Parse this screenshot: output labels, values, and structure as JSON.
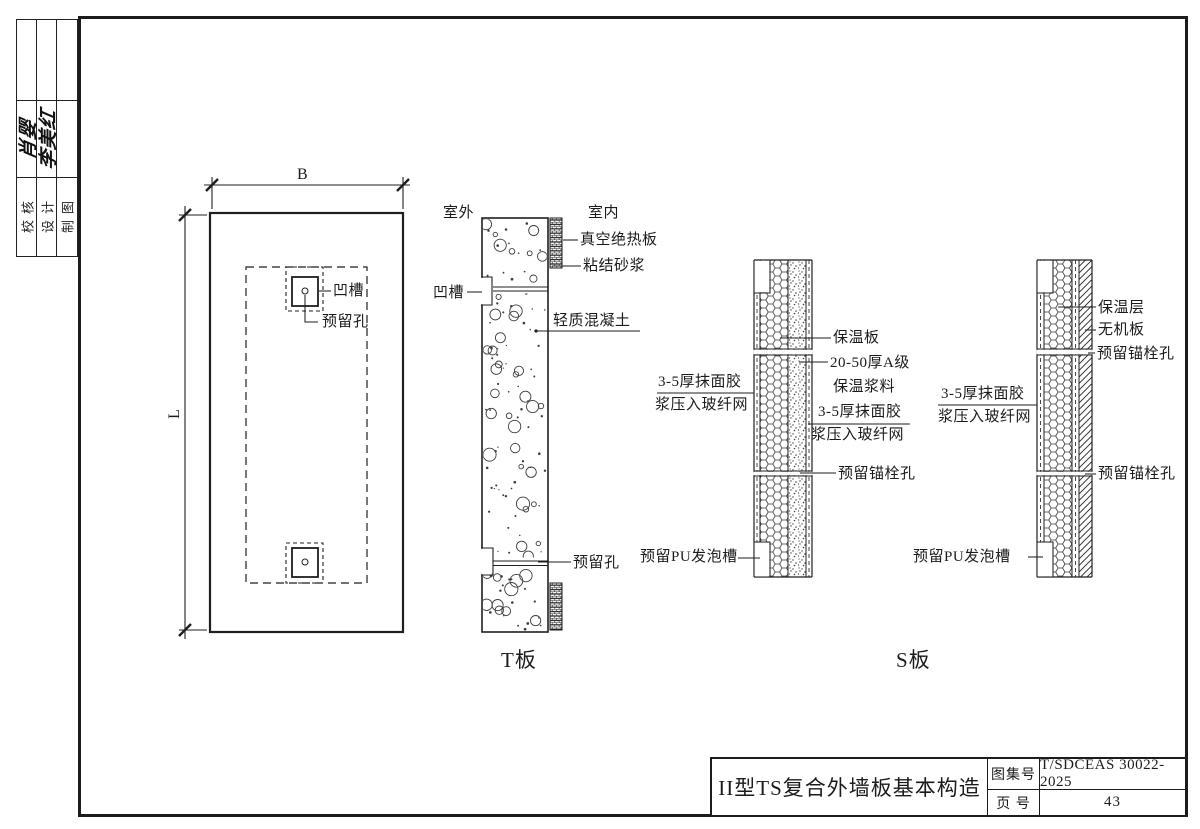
{
  "sidebar": {
    "col1_label": "校核",
    "col2_label": "设计",
    "col3_label": "制图",
    "col1_signature": "肖婴",
    "col2_signature": "李美红"
  },
  "plan": {
    "dim_width": "B",
    "dim_length": "L",
    "groove": "凹槽",
    "reserved_hole": "预留孔"
  },
  "t_panel": {
    "caption": "T板",
    "outdoor": "室外",
    "indoor": "室内",
    "vacuum_insulation_panel": "真空绝热板",
    "bonding_mortar": "粘结砂浆",
    "groove": "凹槽",
    "lightweight_concrete": "轻质混凝土",
    "reserved_hole": "预留孔"
  },
  "s_panel": {
    "caption": "S板",
    "left_section": {
      "insulation_board": "保温板",
      "slurry_line1": "20-50厚A级",
      "slurry_line2": "保温浆料",
      "outer_render_line1": "3-5厚抹面胶",
      "outer_render_line2": "浆压入玻纤网",
      "inner_render_line1": "3-5厚抹面胶",
      "inner_render_line2": "浆压入玻纤网",
      "anchor_hole": "预留锚栓孔",
      "pu_groove": "预留PU发泡槽"
    },
    "right_section": {
      "insulation_layer": "保温层",
      "inorganic_board": "无机板",
      "anchor_hole_top": "预留锚栓孔",
      "render_line1": "3-5厚抹面胶",
      "render_line2": "浆压入玻纤网",
      "anchor_hole_bottom": "预留锚栓孔",
      "pu_groove": "预留PU发泡槽"
    }
  },
  "title_block": {
    "title": "II型TS复合外墙板基本构造",
    "atlas_no_label": "图集号",
    "atlas_no": "T/SDCEAS 30022-2025",
    "page_no_label": "页 号",
    "page_no": "43"
  }
}
